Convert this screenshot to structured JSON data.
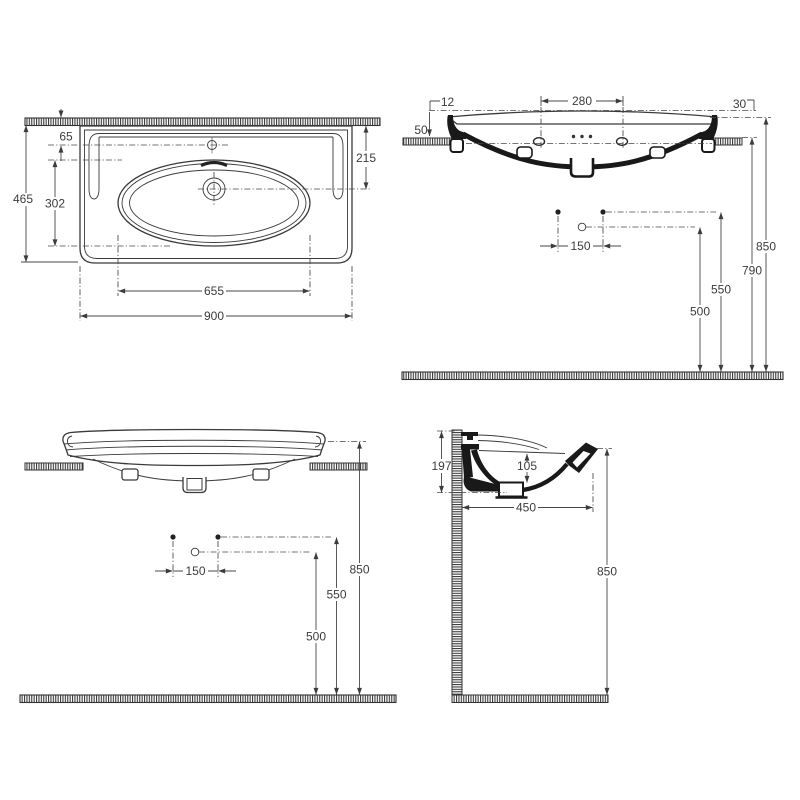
{
  "drawing": {
    "title": "washbasin-installation-dimensions",
    "colors": {
      "background": "#ffffff",
      "line": "#3b3b3b",
      "section_fill": "#191919"
    },
    "views": {
      "plan": {
        "label": "top view",
        "dims": {
          "faucet_to_wall": "65",
          "total_depth": "465",
          "bowl_depth": "302",
          "drain_to_wall": "215",
          "bowl_width": "655",
          "total_width": "900"
        }
      },
      "front_section": {
        "label": "front section",
        "dims": {
          "rim_rise_left": "12",
          "tap_hole_spacing": "280",
          "rim_rise_right": "30",
          "apron_height": "50",
          "fixing_hole_spacing": "150",
          "rim_height": "850",
          "underside_height": "790",
          "fixing_height": "550",
          "outlet_height": "500"
        }
      },
      "front": {
        "label": "front view",
        "dims": {
          "fixing_hole_spacing": "150",
          "rim_height": "850",
          "fixing_height": "550",
          "outlet_height": "500"
        }
      },
      "side_section": {
        "label": "side section",
        "dims": {
          "back_height": "197",
          "basin_depth": "105",
          "projection": "450",
          "rim_height": "850"
        }
      }
    }
  }
}
